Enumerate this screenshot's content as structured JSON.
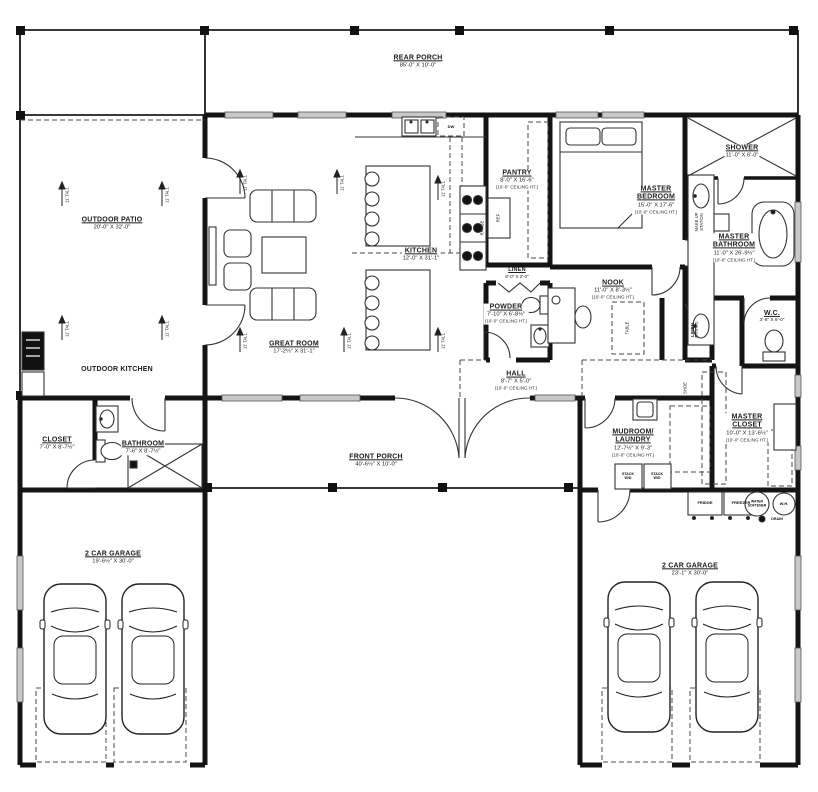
{
  "rooms": {
    "rear_porch": {
      "name": "REAR PORCH",
      "dims": "85'-0\" X 10'-0\""
    },
    "outdoor_patio": {
      "name": "OUTDOOR PATIO",
      "dims": "20'-0\" X 32'-0\""
    },
    "outdoor_kitchen": {
      "name": "OUTDOOR KITCHEN"
    },
    "great_room": {
      "name": "GREAT ROOM",
      "dims": "17'-2½\" X 31'-1\""
    },
    "kitchen": {
      "name": "KITCHEN",
      "dims": "12'-0\" X 31'-1\""
    },
    "pantry": {
      "name": "PANTRY",
      "dims": "8'-0\" X 16'-6\"",
      "note": "(10'-0\" CEILING HT.)"
    },
    "master_bedroom": {
      "name": "MASTER BEDROOM",
      "dims": "15'-0\" X 17'-6\"",
      "note": "(10'-0\" CEILING HT.)"
    },
    "shower": {
      "name": "SHOWER",
      "dims": "11'-0\" X 6'-0\""
    },
    "master_bathroom": {
      "name": "MASTER BATHROOM",
      "dims": "11'-0\" X 26'-9½\"",
      "note": "(10'-0\" CEILING HT.)"
    },
    "linen": {
      "name": "LINEN",
      "dims": "8'-0\" X 2'-0\""
    },
    "powder": {
      "name": "POWDER",
      "dims": "7'-10\" X 6'-8½\"",
      "note": "(10'-0\" CEILING HT.)"
    },
    "nook": {
      "name": "NOOK",
      "dims": "11'-0\" X 8'-3½\"",
      "note": "(10'-0\" CEILING HT.)"
    },
    "hall": {
      "name": "HALL",
      "dims": "8'-7\" X 5'-0\"",
      "note": "(10'-0\" CEILING HT.)"
    },
    "wc": {
      "name": "W.C.",
      "dims": "3'-6\" X 6'-0\""
    },
    "master_closet": {
      "name": "MASTER CLOSET",
      "dims": "10'-0\" X 13'-6½\"",
      "note": "(10'-0\" CEILING HT.)"
    },
    "linen2": {
      "name": "LINEN",
      "dims": "3'-0 X 6'-0"
    },
    "shoe": {
      "name": "SHOE"
    },
    "mudroom": {
      "name": "MUDROOM/ LAUNDRY",
      "dims": "12'-7½\" X 9'-3\"",
      "note": "(10'-0\" CEILING HT.)"
    },
    "closet": {
      "name": "CLOSET",
      "dims": "7'-0\" X 8'-7½\""
    },
    "bathroom": {
      "name": "BATHROOM",
      "dims": "7'-6\" X 8'-7½\""
    },
    "front_porch": {
      "name": "FRONT PORCH",
      "dims": "40'-6½\" X 10'-0\""
    },
    "garage_left": {
      "name": "2 CAR GARAGE",
      "dims": "19'-6½\" X 30'-0\""
    },
    "garage_right": {
      "name": "2 CAR GARAGE",
      "dims": "23'-1\" X 30'-0\""
    }
  },
  "fixtures": {
    "dw": "DW",
    "ref": "REF",
    "range": "RANGE",
    "fridge": "FRIDGE",
    "freezer": "FREEZER",
    "water_softener": "WATER SOFTENER",
    "wh": "W.H.",
    "drain": "DRAIN",
    "stack_wd": "STACK W/D",
    "makeup": "MAKE UP STATION",
    "table": "TABLE",
    "height_marker": "11' TALL"
  },
  "colors": {
    "wall": "#141414",
    "window": "#c8c8c8",
    "line": "#333333"
  }
}
